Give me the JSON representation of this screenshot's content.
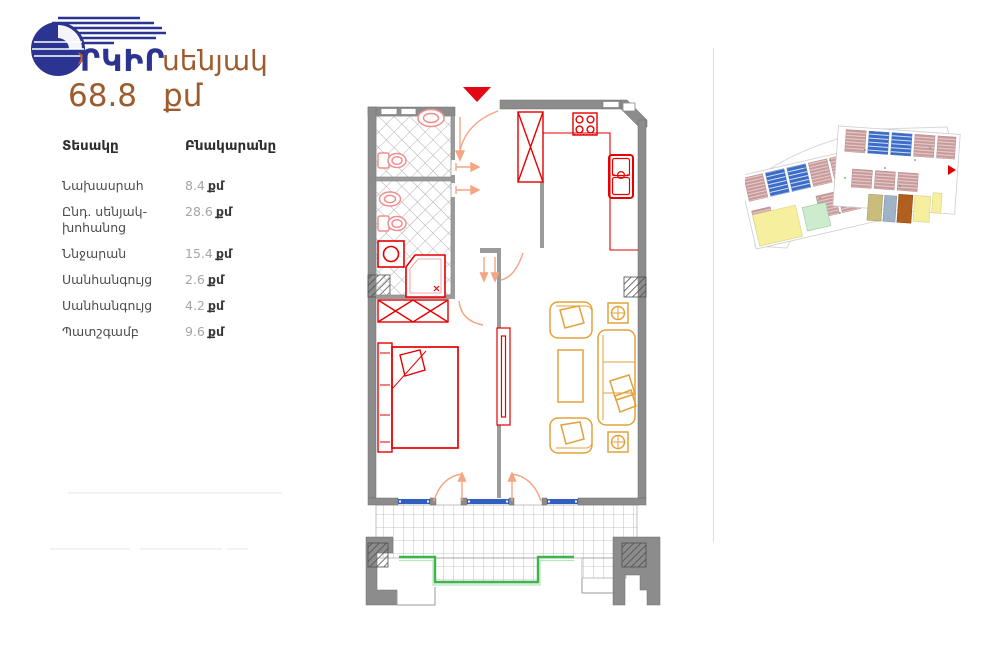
{
  "brand": {
    "logo_text": "ՐԿԻՐ"
  },
  "unit": {
    "type_label": "սենյակ",
    "area_value": "68.8",
    "area_unit": "քմ"
  },
  "table": {
    "col_type": "Տեսակը",
    "col_building": "Բնակարանը",
    "rows": [
      {
        "label": "Նախասրահ",
        "value": "8.4",
        "unit": "քմ"
      },
      {
        "label": "Ընդ. սենյակ-խոհանոց",
        "value": "28.6",
        "unit": "քմ"
      },
      {
        "label": "Ննջարան",
        "value": "15.4",
        "unit": "քմ"
      },
      {
        "label": "Սանհանգույց",
        "value": "2.6",
        "unit": "քմ"
      },
      {
        "label": "Սանհանգույց",
        "value": "4.2",
        "unit": "քմ"
      },
      {
        "label": "Պատշգամբ",
        "value": "9.6",
        "unit": "քմ"
      }
    ]
  },
  "colors": {
    "brand_blue": "#2b3490",
    "accent_brown": "#9d5c2d",
    "wall_gray": "#8c8c8c",
    "fixture_red": "#e60000",
    "bath_fixture_pink": "#ef8f8f",
    "furniture_orange": "#e2a23b",
    "door_arc_orange": "#f4a582",
    "window_blue": "#2f5fc0",
    "balcony_rail_green": "#3cb54a",
    "entrance_marker_red": "#e30613",
    "minimap_unit_pink": "#c99a9a",
    "minimap_unit_blue": "#3a6cc8",
    "minimap_unit_yellow": "#f5ef9e",
    "minimap_unit_green": "#cdeccd",
    "minimap_unit_tan": "#c9bc7c",
    "minimap_unit_bluegray": "#9fb3c8",
    "minimap_highlight_brown": "#b05f1f"
  }
}
